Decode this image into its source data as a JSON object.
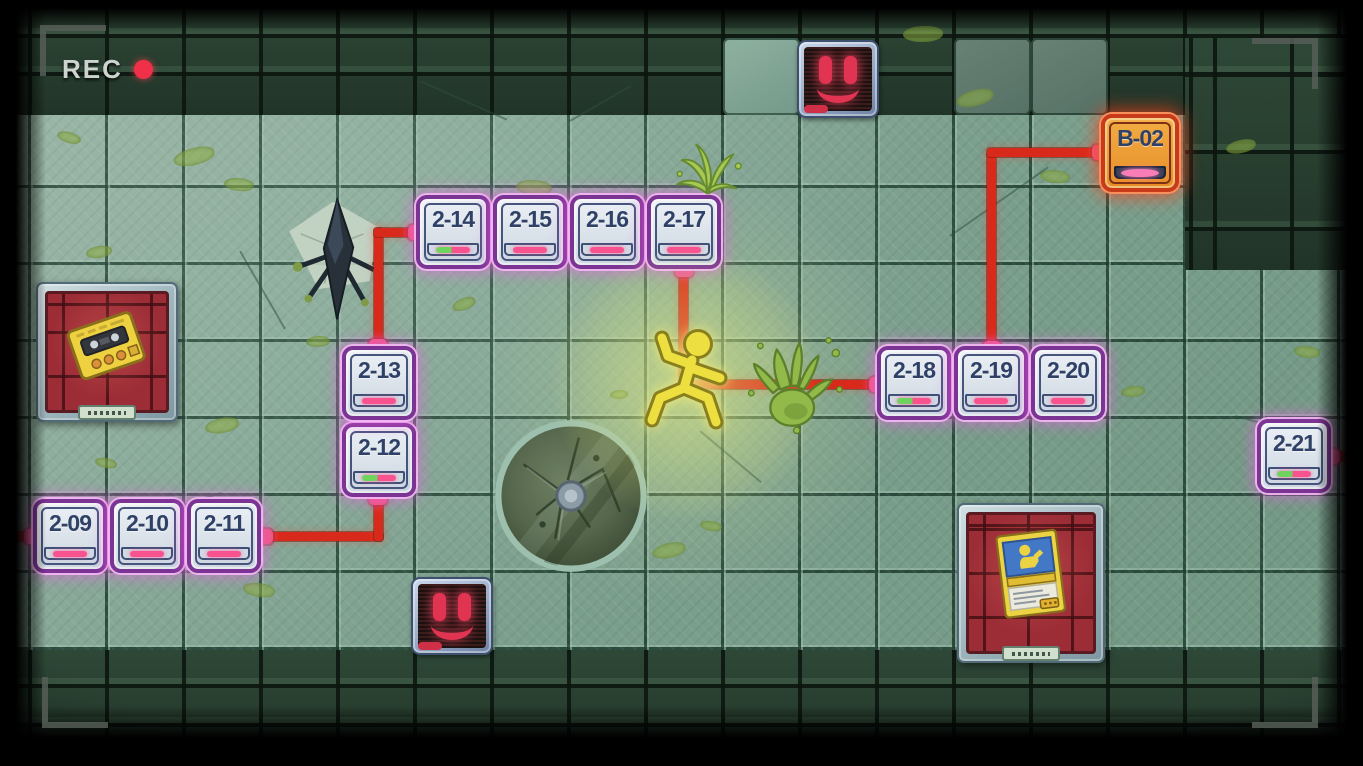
{
  "hud": {
    "rec_label": "REC"
  },
  "map": {
    "tile_size": 77,
    "nodes": [
      {
        "id": "2-09",
        "label": "2-09",
        "type": "normal",
        "indicator": "pink",
        "x": 33,
        "y": 499
      },
      {
        "id": "2-10",
        "label": "2-10",
        "type": "normal",
        "indicator": "pink",
        "x": 110,
        "y": 499
      },
      {
        "id": "2-11",
        "label": "2-11",
        "type": "normal",
        "indicator": "pink",
        "x": 187,
        "y": 499
      },
      {
        "id": "2-12",
        "label": "2-12",
        "type": "normal",
        "indicator": "green-pink",
        "x": 342,
        "y": 423
      },
      {
        "id": "2-13",
        "label": "2-13",
        "type": "normal",
        "indicator": "pink",
        "x": 342,
        "y": 346
      },
      {
        "id": "2-14",
        "label": "2-14",
        "type": "normal",
        "indicator": "green-pink",
        "x": 416,
        "y": 195
      },
      {
        "id": "2-15",
        "label": "2-15",
        "type": "normal",
        "indicator": "pink",
        "x": 493,
        "y": 195
      },
      {
        "id": "2-16",
        "label": "2-16",
        "type": "normal",
        "indicator": "pink",
        "x": 570,
        "y": 195
      },
      {
        "id": "2-17",
        "label": "2-17",
        "type": "normal",
        "indicator": "pink",
        "x": 647,
        "y": 195
      },
      {
        "id": "2-18",
        "label": "2-18",
        "type": "normal",
        "indicator": "green-pink",
        "x": 877,
        "y": 346
      },
      {
        "id": "2-19",
        "label": "2-19",
        "type": "normal",
        "indicator": "pink",
        "x": 954,
        "y": 346
      },
      {
        "id": "2-20",
        "label": "2-20",
        "type": "normal",
        "indicator": "pink",
        "x": 1031,
        "y": 346
      },
      {
        "id": "2-21",
        "label": "2-21",
        "type": "normal",
        "indicator": "green-pink",
        "x": 1257,
        "y": 419
      },
      {
        "id": "B-02",
        "label": "B-02",
        "type": "bonus",
        "indicator": "pink-oval",
        "x": 1101,
        "y": 114
      }
    ],
    "edges": [
      [
        0,
        532,
        383,
        9
      ],
      [
        374,
        490,
        9,
        51
      ],
      [
        374,
        228,
        9,
        122
      ],
      [
        374,
        228,
        46,
        9
      ],
      [
        679,
        265,
        9,
        122
      ],
      [
        679,
        380,
        202,
        9
      ],
      [
        987,
        152,
        9,
        200
      ],
      [
        987,
        148,
        118,
        9
      ],
      [
        1327,
        452,
        22,
        9
      ]
    ],
    "nubs": [
      [
        24,
        529
      ],
      [
        101,
        529
      ],
      [
        178,
        529
      ],
      [
        255,
        529
      ],
      [
        369,
        490
      ],
      [
        369,
        414
      ],
      [
        369,
        339
      ],
      [
        408,
        225
      ],
      [
        485,
        225
      ],
      [
        562,
        225
      ],
      [
        639,
        225
      ],
      [
        675,
        262
      ],
      [
        869,
        377
      ],
      [
        946,
        377
      ],
      [
        1023,
        377
      ],
      [
        983,
        341
      ],
      [
        1092,
        145
      ],
      [
        1322,
        449
      ]
    ],
    "colors": {
      "path_red": "#dd2214",
      "nub_pink": "#f2537c",
      "node_border_purple": "#7b2c94",
      "label_navy": "#2c3a66",
      "indicator_pink": "#ff4d8f",
      "indicator_green": "#6fd45a",
      "bonus_border_red": "#cc3414",
      "rec_red": "#f03048"
    }
  },
  "entities": {
    "player": {
      "name": "player-character"
    },
    "slime_hand": {
      "name": "slime-splat-hand"
    },
    "plant": {
      "name": "slime-plant"
    },
    "drone": {
      "name": "crashed-drone"
    },
    "hatch": {
      "name": "floor-hatch"
    },
    "monitors": [
      {
        "name": "face-monitor-top"
      },
      {
        "name": "face-monitor-bottom"
      }
    ],
    "collectibles": [
      {
        "name": "cassette-player-item"
      },
      {
        "name": "manual-card-item"
      }
    ]
  },
  "decor": {
    "carves": [
      [
        723,
        38,
        0
      ],
      [
        954,
        38,
        1
      ],
      [
        1031,
        38,
        1
      ]
    ],
    "smears": [
      [
        173,
        148,
        42,
        17,
        -12
      ],
      [
        224,
        178,
        30,
        13,
        8
      ],
      [
        57,
        132,
        24,
        11,
        18
      ],
      [
        86,
        246,
        26,
        12,
        -6
      ],
      [
        205,
        418,
        34,
        15,
        -8
      ],
      [
        243,
        583,
        32,
        14,
        10
      ],
      [
        306,
        336,
        24,
        11,
        0
      ],
      [
        452,
        298,
        24,
        12,
        -18
      ],
      [
        516,
        180,
        36,
        15,
        6
      ],
      [
        610,
        390,
        18,
        9,
        0
      ],
      [
        652,
        543,
        34,
        15,
        -10
      ],
      [
        700,
        521,
        22,
        10,
        12
      ],
      [
        903,
        26,
        40,
        16,
        0
      ],
      [
        956,
        90,
        38,
        16,
        -12
      ],
      [
        1040,
        170,
        30,
        13,
        8
      ],
      [
        1121,
        386,
        24,
        11,
        -4
      ],
      [
        1226,
        140,
        30,
        13,
        -10
      ],
      [
        1294,
        346,
        26,
        12,
        8
      ],
      [
        95,
        458,
        22,
        10,
        14
      ],
      [
        150,
        328,
        20,
        10,
        -10
      ],
      [
        820,
        95,
        26,
        12,
        6
      ],
      [
        1300,
        480,
        28,
        12,
        -8
      ]
    ],
    "cracks": [
      [
        420,
        80,
        95,
        24
      ],
      [
        570,
        120,
        70,
        -30
      ],
      [
        950,
        235,
        120,
        -35
      ],
      [
        1235,
        415,
        80,
        15
      ],
      [
        150,
        515,
        75,
        -18
      ],
      [
        700,
        430,
        80,
        40
      ],
      [
        240,
        250,
        90,
        60
      ]
    ]
  }
}
